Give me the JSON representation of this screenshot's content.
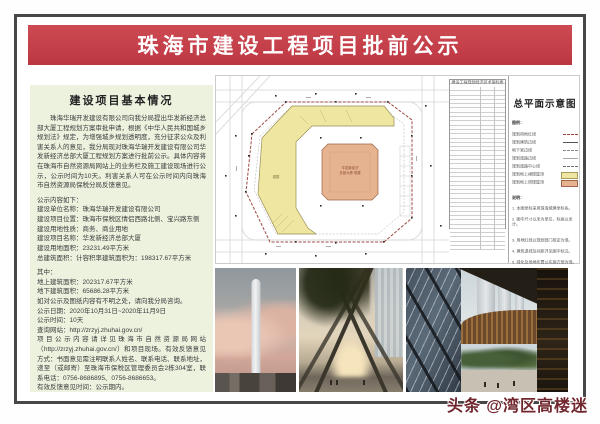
{
  "page": {
    "title": "珠海市建设工程项目批前公示"
  },
  "notice": {
    "section_title": "建设项目基本情况",
    "intro": "珠海华瑞开发建设有限公司向我分局提出华发新经济总部大厦工程规划方案审批申请，根据《中华人民共和国城乡规划法》规定，为增强城乡规划透明度，充分征求公众及利害关系人的意见，我分局现对珠海华瑞开发建设有限公司华发新经济总部大厦工程规划方案进行批前公示。具体内容将在珠海市自然资源局网站上的业务栏及施工建设现场进行公示，公示时间为10天。利害关系人可在公示时间内向珠海市自然资源局保税分局反馈意见。",
    "content_label": "公示内容如下：",
    "fields": [
      "建设单位名称：珠海华瑞开发建设有限公司",
      "建设项目位置：珠海市保税区情侣西路北侧、宝兴路东侧",
      "建设用地性质：商务、商业用地",
      "建设项目名称：华发新经济总部大厦",
      "建设用地面积：23231.49平方米",
      "总建筑面积：计容积率建筑面积为：198317.67平方米"
    ],
    "among_label": "其中：",
    "sub_fields": [
      "地上建筑面积：202317.67平方米",
      "地下建筑面积：65686.28平方米"
    ],
    "remark": "如对公示及图纸内容有不明之处，请向我分局咨询。",
    "dates": [
      "公示日期：2020年10月31日~2020年11月9日",
      "公示时间：10天",
      "查询网站：http://zrzyj.zhuhai.gov.cn/"
    ],
    "feedback": "项目公示内容请详见珠海市自然资源局网站（http://zrzyj.zhuhai.gov.cn/）和项目现场。有效反馈意见方式：书面意见需注明联系人姓名、联系电话、联系地址，递至（或邮寄）至珠海市保税区管理委员会2栋304室，联系电话：0756-8686895、0756-8686653。",
    "feedback_time": "有效反馈意见时间：公示期内。",
    "issuer": "珠海市自然资源局保税分局",
    "issue_date": "2020年10月31日"
  },
  "site_plan": {
    "sheet_title": "总平面示意图",
    "indicator_table": {
      "title": "建设工程规划经济技术指标表",
      "row_count": 38
    },
    "legend_title": "图例：",
    "legend_items": [
      {
        "label": "规划用地红线",
        "sample": "red-dashed-line"
      },
      {
        "label": "规划建筑边线",
        "sample": "solid-line"
      },
      {
        "label": "地下室边线",
        "sample": "dashed-line"
      },
      {
        "label": "规划道路边线",
        "sample": "road-line"
      },
      {
        "label": "规划道路中心线",
        "sample": "centerline"
      },
      {
        "label": "规划地上裙楼屋顶",
        "sample": "yellow-swatch"
      },
      {
        "label": "规划地上塔楼屋顶",
        "sample": "orange-swatch"
      }
    ],
    "notes_title": "说明：",
    "notes": [
      "1. 本图坐标采用珠海城建坐标系。",
      "2. 图中尺寸以米为单位，标高以米计。",
      "3. 用地红线以规划部门核定为准。",
      "4. 建筑退线及间距详见图中标注。",
      "5. 绿化及场地布置以实施方案为准。"
    ],
    "tower_label1": "华发新经济",
    "tower_label2": "总部大厦 塔楼",
    "podium_label": "裙楼"
  },
  "photos": [
    {
      "name": "tower-skyline-render"
    },
    {
      "name": "podium-entrance-render"
    },
    {
      "name": "courtyard-render"
    }
  ],
  "watermark": {
    "text": "头条 @湾区高楼迷"
  },
  "colors": {
    "banner_red": "#c23d47",
    "panel_green": "#edf2df",
    "podium_yellow": "#efe7a1",
    "tower_orange": "#e6b391",
    "boundary_red": "#9e4a42",
    "watermark_red": "#70262c"
  }
}
